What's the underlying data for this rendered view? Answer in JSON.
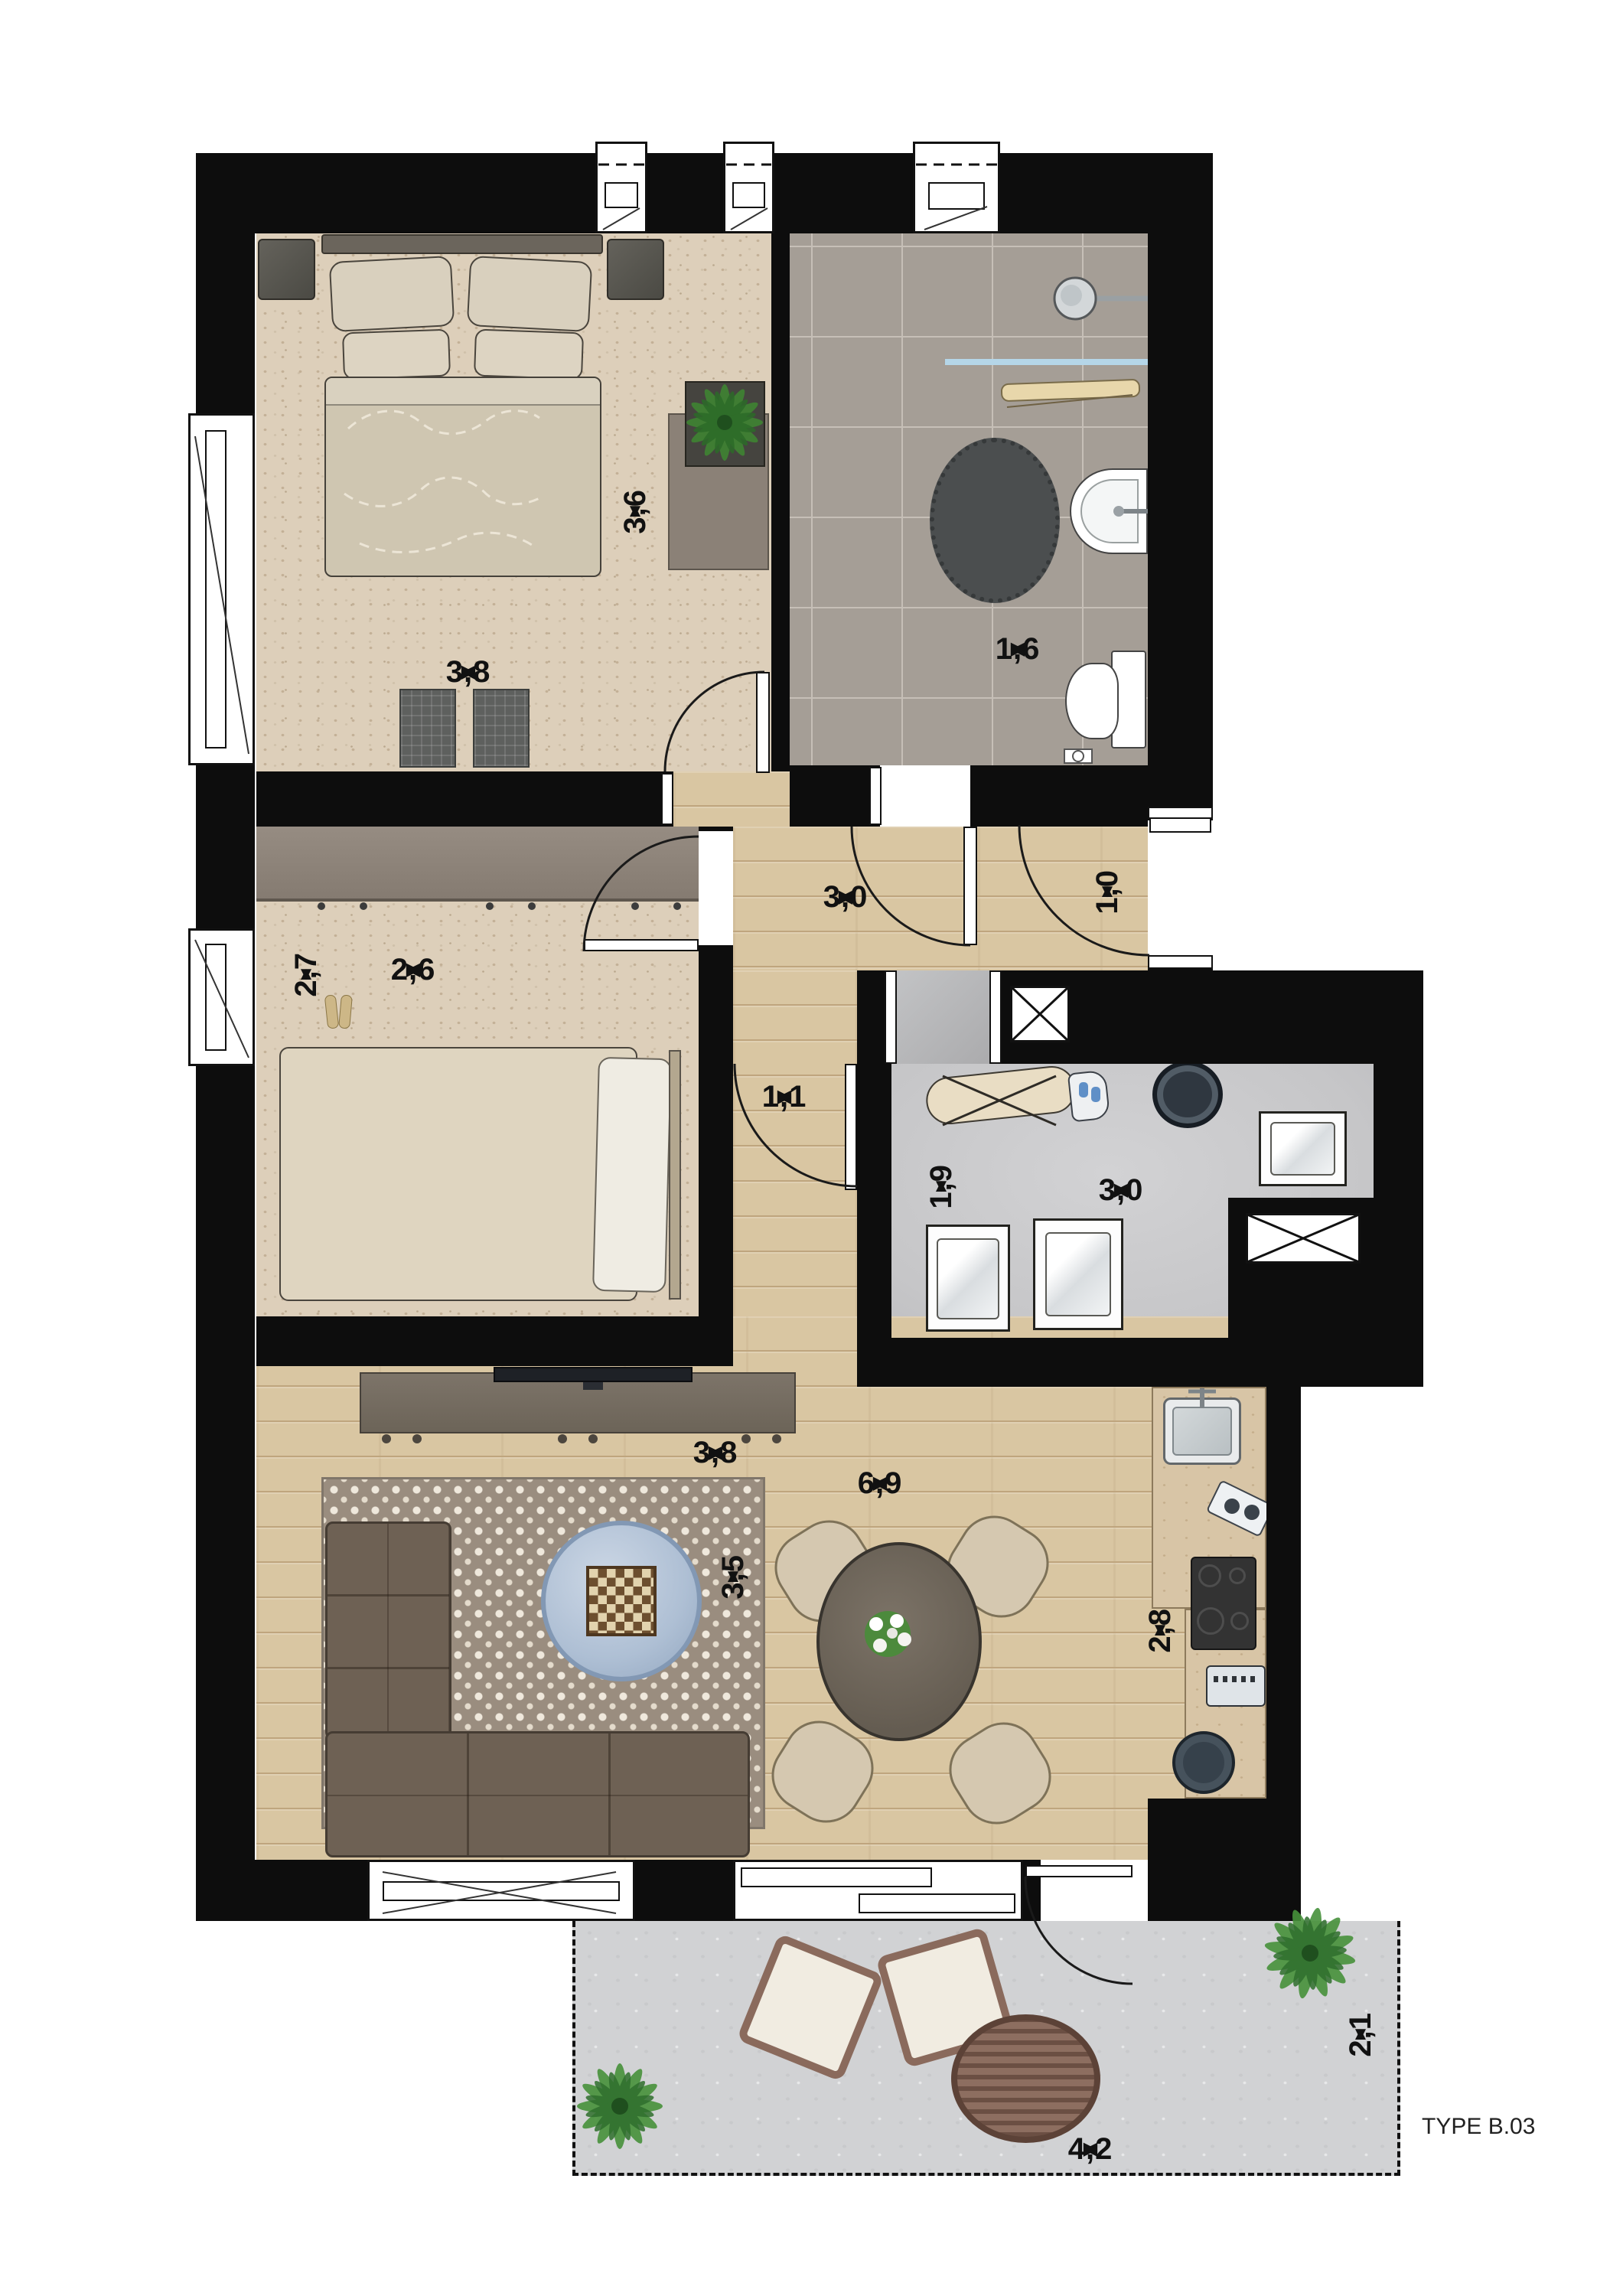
{
  "title": "TYPE B.03",
  "arrows": {
    "l": "◀",
    "r": "▶",
    "u": "▲",
    "d": "▼"
  },
  "dims": {
    "bedroom1_width": "3,8",
    "bedroom1_depth": "3,6",
    "bathroom_width": "1,6",
    "hall_width": "3,0",
    "entrance_width": "1,0",
    "corridor_width": "1,1",
    "bedroom2_depth": "2,7",
    "bedroom2_width": "2,6",
    "utility_depth": "1,9",
    "utility_width": "3,0",
    "living_top_width": "3,8",
    "living_width": "6,9",
    "living_depth": "3,5",
    "kitchen_depth": "2,8",
    "terrace_width": "4,2",
    "terrace_depth": "2,1"
  },
  "colors": {
    "wall": "#0d0d0d",
    "carpet": "#ddcfba",
    "wood": "#d9c6a2",
    "tile": "#a59e96",
    "utility_floor": "#c9c9cb",
    "terrace": "#d1d2d4",
    "polka_rug": "#9a8d7f",
    "sofa": "#6e6154",
    "shower_glass": "#b5d6e8",
    "furniture_beige": "#d7cab2",
    "appliance_dark": "#3a3a3a"
  }
}
